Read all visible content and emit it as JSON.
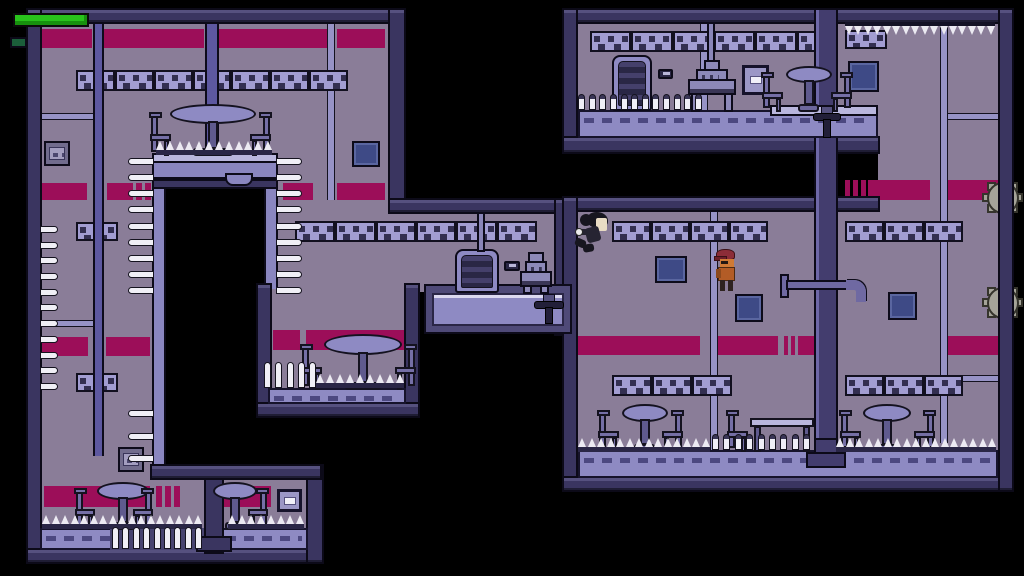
{
  "meta": {
    "type": "game-screenshot",
    "viewport": {
      "w": 1024,
      "h": 576
    }
  },
  "palette": {
    "background": "#000000",
    "room_interior": "#8a7d98",
    "wall": "#3a3560",
    "accent_stripe": "#9c0e59",
    "seam": "#9793c6",
    "pillar_strip": "#5d58a0",
    "band_bg": "#a29dd2",
    "band_dark": "#332f51",
    "floor_slab": "#8e8ac3",
    "ledge_light": "#b9b6dd",
    "pit_wall": "#8a86c0",
    "big_pillar": "#433d6e",
    "spike_white": "#f0eff6",
    "gear_gray": "#a5a499",
    "pipe": "#6f69a2",
    "panel_blue": "#3e4a86",
    "panel_cell": "#93a6e2",
    "panel_gray": "#716c8d",
    "furniture": "#756fa6",
    "locker_dark": "#2a2745",
    "health_green": "#29c31c",
    "indicator_green": "#1b5e3a"
  },
  "hud": {
    "health_bar": {
      "x": 13,
      "y": 13,
      "w": 76,
      "h": 14,
      "percent": 100
    },
    "indicator": {
      "x": 10,
      "y": 37,
      "w": 17,
      "h": 11
    }
  },
  "characters": {
    "player": {
      "x": 574,
      "y": 212,
      "w": 40,
      "h": 42,
      "pose": "jumping-left"
    },
    "enemy": {
      "x": 714,
      "y": 249,
      "w": 27,
      "h": 42,
      "pose": "standing-left"
    }
  },
  "scene": {
    "elements": [
      {
        "t": "interior",
        "x": 40,
        "y": 22,
        "w": 348,
        "h": 178
      },
      {
        "t": "interior",
        "x": 40,
        "y": 200,
        "w": 112,
        "h": 266
      },
      {
        "t": "interior",
        "x": 40,
        "y": 466,
        "w": 268,
        "h": 84
      },
      {
        "t": "interior",
        "x": 278,
        "y": 200,
        "w": 278,
        "h": 92
      },
      {
        "t": "interior",
        "x": 270,
        "y": 287,
        "w": 136,
        "h": 108
      },
      {
        "t": "interior",
        "x": 578,
        "y": 22,
        "w": 300,
        "h": 118
      },
      {
        "t": "interior",
        "x": 878,
        "y": 22,
        "w": 120,
        "h": 190
      },
      {
        "t": "interior",
        "x": 578,
        "y": 212,
        "w": 420,
        "h": 252
      },
      {
        "t": "stripe",
        "x": 40,
        "y": 29,
        "w": 52,
        "h": 19
      },
      {
        "t": "stripe",
        "x": 104,
        "y": 29,
        "w": 100,
        "h": 19
      },
      {
        "t": "stripe",
        "x": 219,
        "y": 29,
        "w": 110,
        "h": 19
      },
      {
        "t": "stripe",
        "x": 337,
        "y": 29,
        "w": 48,
        "h": 19
      },
      {
        "t": "stripe",
        "x": 37,
        "y": 183,
        "w": 50,
        "h": 17
      },
      {
        "t": "stripe",
        "x": 107,
        "y": 183,
        "w": 26,
        "h": 17
      },
      {
        "t": "stripe",
        "x": 136,
        "y": 183,
        "w": 6,
        "h": 17
      },
      {
        "t": "stripe",
        "x": 145,
        "y": 183,
        "w": 6,
        "h": 17
      },
      {
        "t": "stripe",
        "x": 283,
        "y": 183,
        "w": 30,
        "h": 17
      },
      {
        "t": "stripe",
        "x": 337,
        "y": 183,
        "w": 48,
        "h": 17
      },
      {
        "t": "stripe",
        "x": 38,
        "y": 337,
        "w": 50,
        "h": 19
      },
      {
        "t": "stripe",
        "x": 106,
        "y": 337,
        "w": 44,
        "h": 19
      },
      {
        "t": "stripe",
        "x": 273,
        "y": 330,
        "w": 27,
        "h": 20
      },
      {
        "t": "stripe",
        "x": 306,
        "y": 330,
        "w": 98,
        "h": 20
      },
      {
        "t": "stripe",
        "x": 44,
        "y": 486,
        "w": 106,
        "h": 21
      },
      {
        "t": "stripe",
        "x": 156,
        "y": 486,
        "w": 6,
        "h": 21
      },
      {
        "t": "stripe",
        "x": 165,
        "y": 486,
        "w": 6,
        "h": 21
      },
      {
        "t": "stripe",
        "x": 174,
        "y": 486,
        "w": 6,
        "h": 21
      },
      {
        "t": "stripe",
        "x": 213,
        "y": 486,
        "w": 58,
        "h": 21
      },
      {
        "t": "stripe",
        "x": 845,
        "y": 180,
        "w": 5,
        "h": 20
      },
      {
        "t": "stripe",
        "x": 853,
        "y": 180,
        "w": 5,
        "h": 20
      },
      {
        "t": "stripe",
        "x": 861,
        "y": 180,
        "w": 5,
        "h": 20
      },
      {
        "t": "stripe",
        "x": 868,
        "y": 180,
        "w": 62,
        "h": 20
      },
      {
        "t": "stripe",
        "x": 948,
        "y": 180,
        "w": 50,
        "h": 20
      },
      {
        "t": "stripe",
        "x": 578,
        "y": 336,
        "w": 122,
        "h": 19
      },
      {
        "t": "stripe",
        "x": 712,
        "y": 336,
        "w": 66,
        "h": 19
      },
      {
        "t": "stripe",
        "x": 784,
        "y": 336,
        "w": 4,
        "h": 19
      },
      {
        "t": "stripe",
        "x": 791,
        "y": 336,
        "w": 4,
        "h": 19
      },
      {
        "t": "stripe",
        "x": 798,
        "y": 336,
        "w": 38,
        "h": 19
      },
      {
        "t": "stripe",
        "x": 948,
        "y": 336,
        "w": 50,
        "h": 19
      },
      {
        "t": "seam",
        "x": 327,
        "y": 22,
        "w": 8,
        "h": 178
      },
      {
        "t": "seam",
        "x": 700,
        "y": 22,
        "w": 8,
        "h": 90
      },
      {
        "t": "seam",
        "x": 940,
        "y": 22,
        "w": 8,
        "h": 421
      },
      {
        "t": "seam",
        "x": 710,
        "y": 212,
        "w": 8,
        "h": 240
      },
      {
        "t": "seam",
        "x": 40,
        "y": 113,
        "w": 53,
        "h": 7
      },
      {
        "t": "seam",
        "x": 40,
        "y": 320,
        "w": 53,
        "h": 7
      },
      {
        "t": "seam",
        "x": 948,
        "y": 113,
        "w": 50,
        "h": 7
      },
      {
        "t": "seam",
        "x": 948,
        "y": 375,
        "w": 50,
        "h": 7
      },
      {
        "t": "band",
        "x": 76,
        "y": 70,
        "w": 272,
        "h": 21
      },
      {
        "t": "band",
        "x": 295,
        "y": 221,
        "w": 242,
        "h": 21
      },
      {
        "t": "band",
        "x": 612,
        "y": 221,
        "w": 156,
        "h": 21
      },
      {
        "t": "band",
        "x": 845,
        "y": 221,
        "w": 118,
        "h": 21
      },
      {
        "t": "band",
        "x": 612,
        "y": 375,
        "w": 120,
        "h": 21
      },
      {
        "t": "band",
        "x": 845,
        "y": 375,
        "w": 118,
        "h": 21
      },
      {
        "t": "band",
        "x": 590,
        "y": 31,
        "w": 248,
        "h": 21
      },
      {
        "t": "band",
        "x": 845,
        "y": 30,
        "w": 42,
        "h": 19
      },
      {
        "t": "band",
        "x": 76,
        "y": 222,
        "w": 42,
        "h": 19
      },
      {
        "t": "band",
        "x": 76,
        "y": 373,
        "w": 42,
        "h": 19
      },
      {
        "t": "strip",
        "x": 93,
        "y": 22,
        "w": 11,
        "h": 434
      },
      {
        "t": "strip",
        "x": 205,
        "y": 22,
        "w": 14,
        "h": 141
      },
      {
        "t": "rect",
        "x": 165,
        "y": 178,
        "w": 100,
        "h": 290,
        "c": "#000000",
        "n": "pit-shaft"
      },
      {
        "t": "strip",
        "x": 152,
        "y": 153,
        "w": 14,
        "h": 315,
        "c": "#8a86c0",
        "n": "pit-wall"
      },
      {
        "t": "strip",
        "x": 264,
        "y": 153,
        "w": 14,
        "h": 136,
        "c": "#8a86c0",
        "n": "pit-wall"
      },
      {
        "t": "wall",
        "x": 26,
        "y": 8,
        "w": 380,
        "h": 16
      },
      {
        "t": "wall",
        "x": 26,
        "y": 8,
        "w": 16,
        "h": 556
      },
      {
        "t": "wall",
        "x": 26,
        "y": 548,
        "w": 298,
        "h": 16
      },
      {
        "t": "wall",
        "x": 306,
        "y": 464,
        "w": 18,
        "h": 100
      },
      {
        "t": "wall",
        "x": 150,
        "y": 464,
        "w": 172,
        "h": 16
      },
      {
        "t": "wall",
        "x": 388,
        "y": 8,
        "w": 18,
        "h": 206
      },
      {
        "t": "wall",
        "x": 388,
        "y": 198,
        "w": 184,
        "h": 16
      },
      {
        "t": "wall",
        "x": 554,
        "y": 198,
        "w": 18,
        "h": 138
      },
      {
        "t": "wall",
        "x": 256,
        "y": 283,
        "w": 16,
        "h": 135
      },
      {
        "t": "wall",
        "x": 404,
        "y": 283,
        "w": 16,
        "h": 135
      },
      {
        "t": "wall",
        "x": 256,
        "y": 402,
        "w": 164,
        "h": 16
      },
      {
        "t": "wall",
        "x": 562,
        "y": 8,
        "w": 452,
        "h": 16
      },
      {
        "t": "wall",
        "x": 562,
        "y": 8,
        "w": 16,
        "h": 146
      },
      {
        "t": "wall",
        "x": 562,
        "y": 136,
        "w": 318,
        "h": 18
      },
      {
        "t": "wall",
        "x": 562,
        "y": 196,
        "w": 318,
        "h": 16
      },
      {
        "t": "wall",
        "x": 562,
        "y": 196,
        "w": 16,
        "h": 296
      },
      {
        "t": "wall",
        "x": 562,
        "y": 476,
        "w": 452,
        "h": 16
      },
      {
        "t": "pillar",
        "x": 814,
        "y": 8,
        "w": 24,
        "h": 456
      },
      {
        "t": "slab",
        "x": 578,
        "y": 110,
        "w": 300,
        "h": 28,
        "dash": true
      },
      {
        "t": "rail",
        "x": 770,
        "y": 105,
        "w": 108,
        "h": 11
      },
      {
        "t": "slab",
        "x": 578,
        "y": 450,
        "w": 420,
        "h": 28,
        "dash": true
      },
      {
        "t": "block",
        "x": 814,
        "y": 438,
        "w": 24,
        "h": 28,
        "c": "#433d6e",
        "n": "support-column"
      },
      {
        "t": "block",
        "x": 806,
        "y": 452,
        "w": 40,
        "h": 16,
        "c": "#433d6e",
        "n": "column-base"
      },
      {
        "t": "slab",
        "x": 40,
        "y": 528,
        "w": 268,
        "h": 22,
        "dash": true
      },
      {
        "t": "rect",
        "x": 110,
        "y": 528,
        "w": 94,
        "h": 22,
        "c": "#474370",
        "n": "spike-trench"
      },
      {
        "t": "block",
        "x": 204,
        "y": 478,
        "w": 20,
        "h": 76,
        "c": "#3a3560",
        "n": "support-column"
      },
      {
        "t": "block",
        "x": 196,
        "y": 536,
        "w": 36,
        "h": 16,
        "c": "#3a3560",
        "n": "column-base"
      },
      {
        "t": "slab",
        "x": 268,
        "y": 388,
        "w": 138,
        "h": 16,
        "dash": true
      },
      {
        "t": "platform",
        "x": 424,
        "y": 284,
        "w": 148,
        "h": 50
      },
      {
        "t": "hang",
        "x": 152,
        "y": 153,
        "w": 126,
        "h": 36
      },
      {
        "t": "panelg",
        "x": 44,
        "y": 141,
        "w": 26,
        "h": 25
      },
      {
        "t": "panelb",
        "x": 352,
        "y": 141,
        "w": 28,
        "h": 26
      },
      {
        "t": "panelg",
        "x": 118,
        "y": 447,
        "w": 26,
        "h": 25
      },
      {
        "t": "panelb",
        "x": 655,
        "y": 256,
        "w": 32,
        "h": 27
      },
      {
        "t": "panelb",
        "x": 735,
        "y": 294,
        "w": 28,
        "h": 28
      },
      {
        "t": "panelb",
        "x": 888,
        "y": 292,
        "w": 29,
        "h": 28
      },
      {
        "t": "panelb",
        "x": 848,
        "y": 61,
        "w": 31,
        "h": 31
      },
      {
        "t": "frame",
        "x": 742,
        "y": 65,
        "w": 27,
        "h": 30
      },
      {
        "t": "frame",
        "x": 277,
        "y": 489,
        "w": 25,
        "h": 23
      },
      {
        "t": "locker",
        "x": 612,
        "y": 55,
        "w": 40,
        "h": 56
      },
      {
        "t": "locker",
        "x": 455,
        "y": 249,
        "w": 44,
        "h": 44
      },
      {
        "t": "item",
        "x": 658,
        "y": 69,
        "w": 15,
        "h": 10
      },
      {
        "t": "item",
        "x": 504,
        "y": 261,
        "w": 16,
        "h": 10
      },
      {
        "t": "pole",
        "x": 707,
        "y": 22,
        "w": 8,
        "h": 40
      },
      {
        "t": "pole",
        "x": 477,
        "y": 212,
        "w": 8,
        "h": 40
      },
      {
        "t": "machine",
        "x": 686,
        "y": 60,
        "w": 52,
        "h": 52
      },
      {
        "t": "machine",
        "x": 518,
        "y": 252,
        "w": 36,
        "h": 42
      },
      {
        "t": "chair",
        "x": 149,
        "y": 112,
        "w": 23,
        "h": 44
      },
      {
        "t": "tableR",
        "x": 170,
        "y": 104,
        "w": 86,
        "h": 52
      },
      {
        "t": "chair",
        "x": 249,
        "y": 112,
        "w": 23,
        "h": 44,
        "flip": true
      },
      {
        "t": "chair",
        "x": 300,
        "y": 344,
        "w": 23,
        "h": 46
      },
      {
        "t": "tableR",
        "x": 324,
        "y": 334,
        "w": 78,
        "h": 56
      },
      {
        "t": "chair",
        "x": 394,
        "y": 344,
        "w": 23,
        "h": 46,
        "flip": true
      },
      {
        "t": "chair",
        "x": 74,
        "y": 488,
        "w": 22,
        "h": 42
      },
      {
        "t": "tableR",
        "x": 97,
        "y": 482,
        "w": 52,
        "h": 48
      },
      {
        "t": "chair",
        "x": 132,
        "y": 488,
        "w": 22,
        "h": 42,
        "flip": true
      },
      {
        "t": "tableR",
        "x": 213,
        "y": 482,
        "w": 44,
        "h": 48
      },
      {
        "t": "chair",
        "x": 247,
        "y": 488,
        "w": 22,
        "h": 42,
        "flip": true
      },
      {
        "t": "chair",
        "x": 761,
        "y": 72,
        "w": 23,
        "h": 40
      },
      {
        "t": "tableR",
        "x": 786,
        "y": 66,
        "w": 46,
        "h": 46
      },
      {
        "t": "chair",
        "x": 830,
        "y": 72,
        "w": 23,
        "h": 40,
        "flip": true
      },
      {
        "t": "chair",
        "x": 597,
        "y": 410,
        "w": 23,
        "h": 42
      },
      {
        "t": "tableR",
        "x": 622,
        "y": 404,
        "w": 46,
        "h": 48
      },
      {
        "t": "chair",
        "x": 661,
        "y": 410,
        "w": 23,
        "h": 42,
        "flip": true
      },
      {
        "t": "chair",
        "x": 726,
        "y": 410,
        "w": 23,
        "h": 42
      },
      {
        "t": "tableL",
        "x": 750,
        "y": 418,
        "w": 64,
        "h": 34
      },
      {
        "t": "chair",
        "x": 839,
        "y": 410,
        "w": 23,
        "h": 42
      },
      {
        "t": "tableR",
        "x": 863,
        "y": 404,
        "w": 48,
        "h": 48
      },
      {
        "t": "chair",
        "x": 913,
        "y": 410,
        "w": 23,
        "h": 42,
        "flip": true
      },
      {
        "t": "valve",
        "x": 812,
        "y": 106,
        "w": 30,
        "h": 32
      },
      {
        "t": "valve",
        "x": 533,
        "y": 294,
        "w": 32,
        "h": 30
      },
      {
        "t": "pipe",
        "x": 780,
        "y": 272,
        "w": 88,
        "h": 30
      },
      {
        "t": "pins",
        "x": 578,
        "y": 94,
        "w": 124,
        "h": 16,
        "cap": true
      },
      {
        "t": "teeth",
        "x": 845,
        "y": 22,
        "w": 150,
        "h": 13,
        "dir": "down"
      },
      {
        "t": "pinsH",
        "x": 128,
        "y": 158,
        "w": 26,
        "h": 136,
        "dir": "left"
      },
      {
        "t": "pinsH",
        "x": 276,
        "y": 158,
        "w": 26,
        "h": 136,
        "dir": "right"
      },
      {
        "t": "pinsH",
        "x": 128,
        "y": 410,
        "w": 26,
        "h": 52,
        "dir": "left"
      },
      {
        "t": "pinsH",
        "x": 40,
        "y": 226,
        "w": 18,
        "h": 164,
        "dir": "right"
      },
      {
        "t": "teeth",
        "x": 156,
        "y": 141,
        "w": 116,
        "h": 14,
        "rail": true
      },
      {
        "t": "pins",
        "x": 264,
        "y": 362,
        "w": 52,
        "h": 26
      },
      {
        "t": "teeth",
        "x": 316,
        "y": 374,
        "w": 88,
        "h": 14,
        "rail": true
      },
      {
        "t": "teeth",
        "x": 42,
        "y": 515,
        "w": 160,
        "h": 14,
        "rail": true
      },
      {
        "t": "teeth",
        "x": 228,
        "y": 515,
        "w": 76,
        "h": 14,
        "rail": true
      },
      {
        "t": "pins",
        "x": 112,
        "y": 527,
        "w": 90,
        "h": 22
      },
      {
        "t": "teeth",
        "x": 578,
        "y": 438,
        "w": 132,
        "h": 14,
        "rail": true
      },
      {
        "t": "pins",
        "x": 712,
        "y": 434,
        "w": 98,
        "h": 16,
        "cap": true
      },
      {
        "t": "teeth",
        "x": 836,
        "y": 438,
        "w": 160,
        "h": 14,
        "rail": true
      },
      {
        "t": "gear",
        "x": 982,
        "y": 177,
        "w": 42,
        "h": 42
      },
      {
        "t": "gear",
        "x": 982,
        "y": 282,
        "w": 42,
        "h": 42
      },
      {
        "t": "wall",
        "x": 998,
        "y": 8,
        "w": 16,
        "h": 484
      }
    ]
  }
}
